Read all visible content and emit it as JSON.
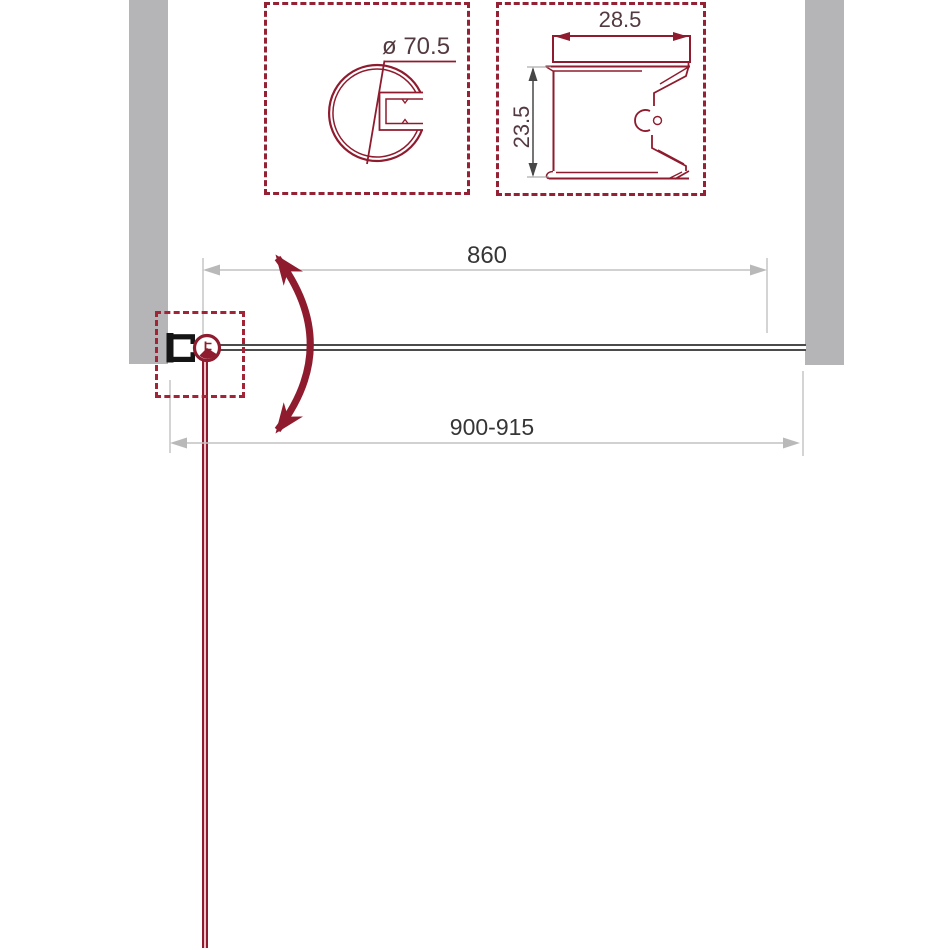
{
  "detail_round_profile": {
    "diameter_label": "ø 70.5"
  },
  "detail_wall_profile": {
    "width_label": "28.5",
    "height_label": "23.5"
  },
  "plan_dimensions": {
    "glass_width": "860",
    "overall_width_range": "900-915"
  },
  "colors": {
    "accent_red": "#8f1b2e",
    "wall_gray": "#b5b5b7",
    "dimension_gray": "#c2c2c2",
    "text_dark": "#363636"
  }
}
